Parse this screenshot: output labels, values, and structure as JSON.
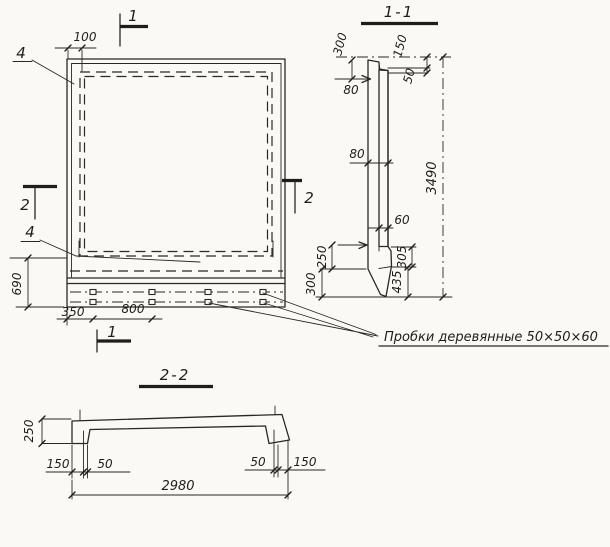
{
  "background": "#faf9f6",
  "ink": "#2b2823",
  "plan": {
    "cut_marks": {
      "top": "1",
      "bottom": "1",
      "left": "2",
      "right": "2"
    },
    "callouts": {
      "top": "4",
      "bottom": "4"
    },
    "dims": {
      "frame_inset": "100",
      "rib_height": "690",
      "plug_edge_offset": "350",
      "plug_spacing": "800"
    }
  },
  "section11": {
    "title": "1-1",
    "dims": {
      "top_offset": "300",
      "crest": "150",
      "crest_step": "50",
      "thickness_top": "80",
      "thickness_mid": "80",
      "thickness_bottom": "60",
      "height": "3490",
      "heel_upper": "250",
      "heel_lower": "300",
      "toe_upper": "305",
      "toe_lower": "435"
    }
  },
  "section22": {
    "title": "2-2",
    "dims": {
      "depth": "250",
      "rib_left": "150",
      "step_left": "50",
      "step_right": "50",
      "rib_right": "150",
      "width": "2980"
    }
  },
  "note": {
    "text": "Пробки деревянные 50×50×60"
  }
}
